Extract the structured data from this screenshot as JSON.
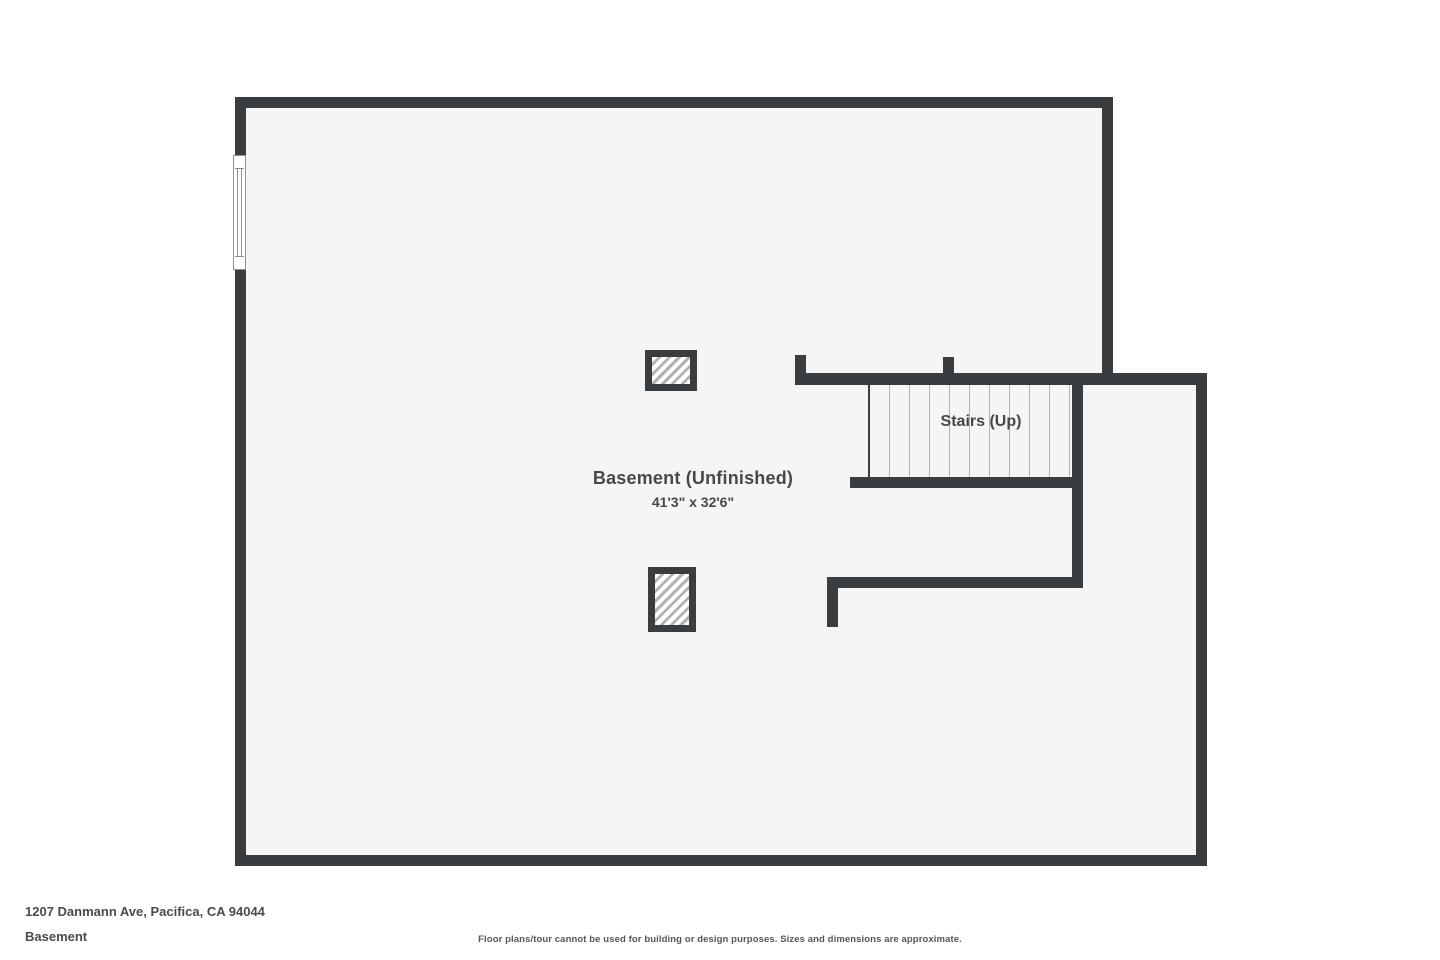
{
  "plan": {
    "room": {
      "name_label": "Basement (Unfinished)",
      "dimensions_label": "41'3\" x 32'6\""
    },
    "stairs": {
      "label": "Stairs (Up)"
    }
  },
  "footer": {
    "address": "1207 Danmann Ave, Pacifica, CA 94044",
    "floor_name": "Basement",
    "disclaimer": "Floor plans/tour cannot be used for building or design purposes. Sizes and dimensions are approximate."
  },
  "colors": {
    "wall": "#3a3d40",
    "interior": "#f5f5f5",
    "hatch": "#b3b3b3",
    "tread": "#b3b3b3",
    "text": "#45494d",
    "footer_text": "#4b4b4b"
  }
}
